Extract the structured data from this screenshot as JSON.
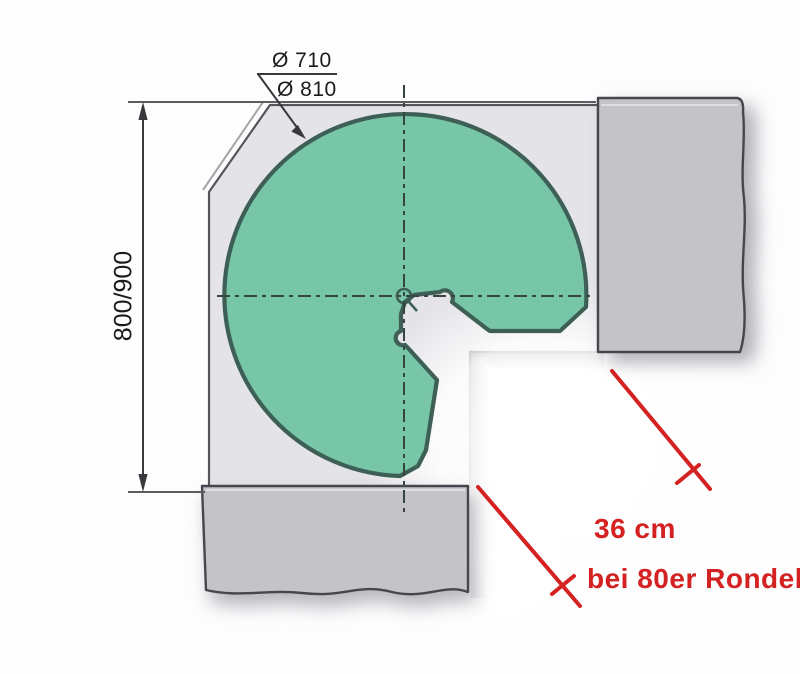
{
  "diagram": {
    "type": "corner-carousel-cabinet-plan",
    "labels": {
      "diameter_inner": "Ø 710",
      "diameter_outer": "Ø 810",
      "width_dimension": "800/900",
      "clearance": "36 cm",
      "note": "bei 80er Rondell"
    },
    "colors": {
      "carousel-green": "#76c6a7",
      "carousel-outline": "#3d5f55",
      "cabinet-fill": "#e4e4e8",
      "cabinet-line": "#55565b",
      "block-fill": "#c3c3c8",
      "block-line": "#46474c",
      "dash-line": "#36463e",
      "dim-line": "#39393d",
      "annotation-red": "#d42121",
      "text-dark": "#1b1b1b"
    }
  }
}
